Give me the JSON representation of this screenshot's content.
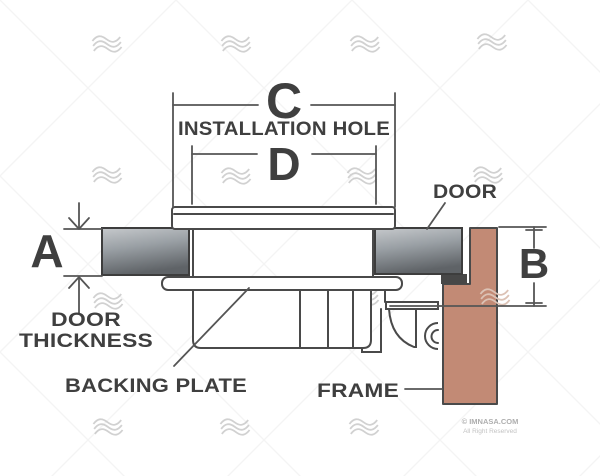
{
  "diagram": {
    "dimension_labels": {
      "a": "A",
      "b": "B",
      "c": "C",
      "d": "D"
    },
    "annotations": {
      "installation_hole": "INSTALLATION HOLE",
      "door": "DOOR",
      "door_thickness_line1": "DOOR",
      "door_thickness_line2": "THICKNESS",
      "backing_plate": "BACKING PLATE",
      "frame": "FRAME"
    },
    "colors": {
      "line": "#4a4a4a",
      "text": "#3f3f3f",
      "door_light": "#c6c9cc",
      "door_mid": "#9aa0a5",
      "door_dark": "#5f6367",
      "door_edge_band": "#474747",
      "frame_fill": "#c28a75",
      "watermark_gray": "#c9c9c9"
    },
    "watermark": {
      "credit_line1": "© IMNASA.COM",
      "credit_line2": "All Right Reserved"
    }
  }
}
